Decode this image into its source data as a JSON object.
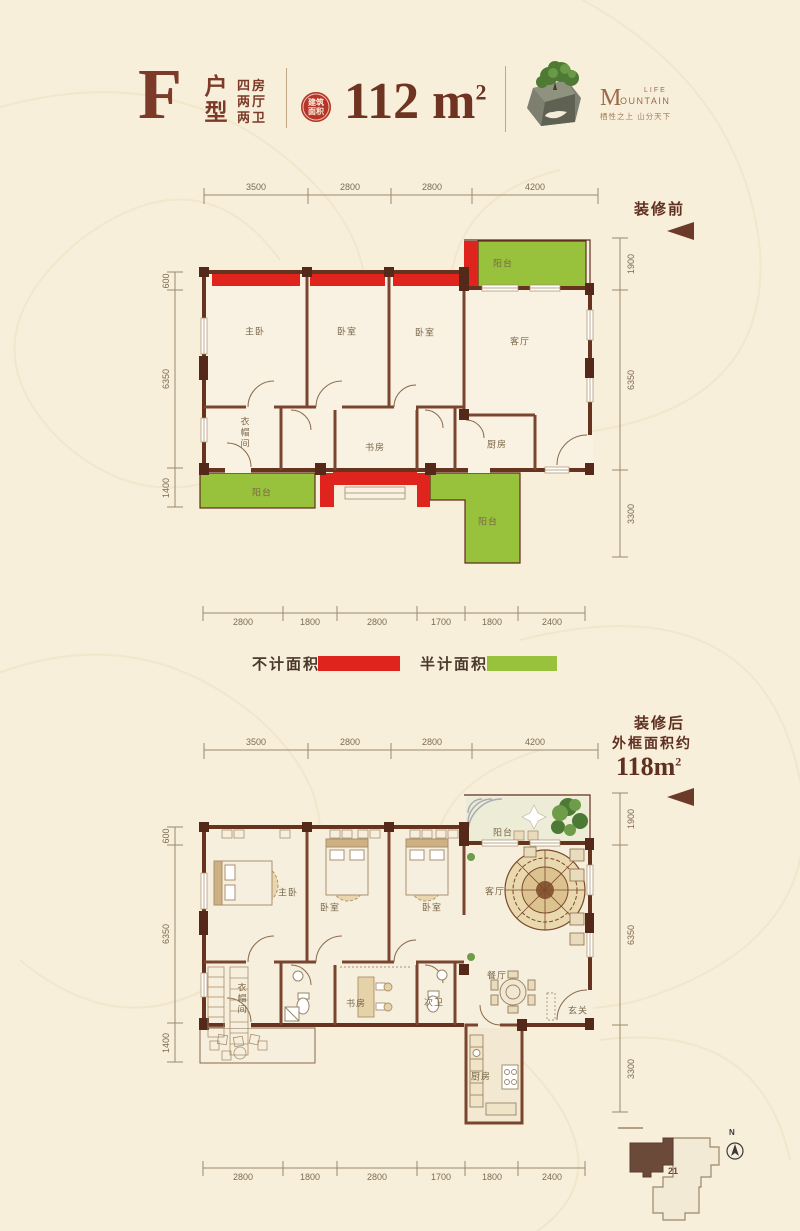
{
  "header": {
    "type_letter": "F",
    "type_label": "户型",
    "spec_lines": [
      "四房",
      "两厅",
      "两卫"
    ],
    "area_badge_line1": "建筑",
    "area_badge_line2": "面积",
    "area_value": "112 m",
    "area_sup": "2",
    "logo": {
      "brand_initial": "M",
      "brand_rest": "OUNTAIN",
      "brand_top": "LIFE",
      "tagline": "栖性之上 山分天下",
      "tree_icon": "bonsai-cube-logo"
    }
  },
  "colors": {
    "not_counted_red": "#df231d",
    "half_counted_green": "#98c23c",
    "wall_brown": "#66331f",
    "background_cream": "#f8efda"
  },
  "plan_before": {
    "label": "装修前",
    "dims_top": [
      "3500",
      "2800",
      "2800",
      "4200"
    ],
    "dims_bottom": [
      "2800",
      "1800",
      "2800",
      "1700",
      "1800",
      "2400"
    ],
    "dims_left": [
      "600",
      "6350",
      "1400"
    ],
    "dims_right": [
      "1900",
      "6350",
      "3300"
    ],
    "rooms": [
      "主卧",
      "卧室",
      "卧室",
      "客厅",
      "阳台",
      "衣帽间",
      "书房",
      "厨房",
      "阳台",
      "阳台"
    ]
  },
  "legend": {
    "items": [
      {
        "label": "不计面积",
        "color": "#df231d"
      },
      {
        "label": "半计面积",
        "color": "#98c23c"
      }
    ]
  },
  "plan_after": {
    "label_line1": "装修后",
    "label_line2": "外框面积约",
    "area_value": "118m",
    "area_sup": "2",
    "dims_top": [
      "3500",
      "2800",
      "2800",
      "4200"
    ],
    "dims_bottom": [
      "2800",
      "1800",
      "2800",
      "1700",
      "1800",
      "2400"
    ],
    "dims_left": [
      "600",
      "6350",
      "1400"
    ],
    "dims_right": [
      "1900",
      "6350",
      "3300"
    ],
    "rooms": [
      "主卧",
      "卧室",
      "卧室",
      "客厅",
      "阳台",
      "衣帽间",
      "书房",
      "次卫",
      "餐厅",
      "玄关",
      "厨房"
    ]
  },
  "site_plan": {
    "unit_number": "21",
    "north_label": "N"
  }
}
